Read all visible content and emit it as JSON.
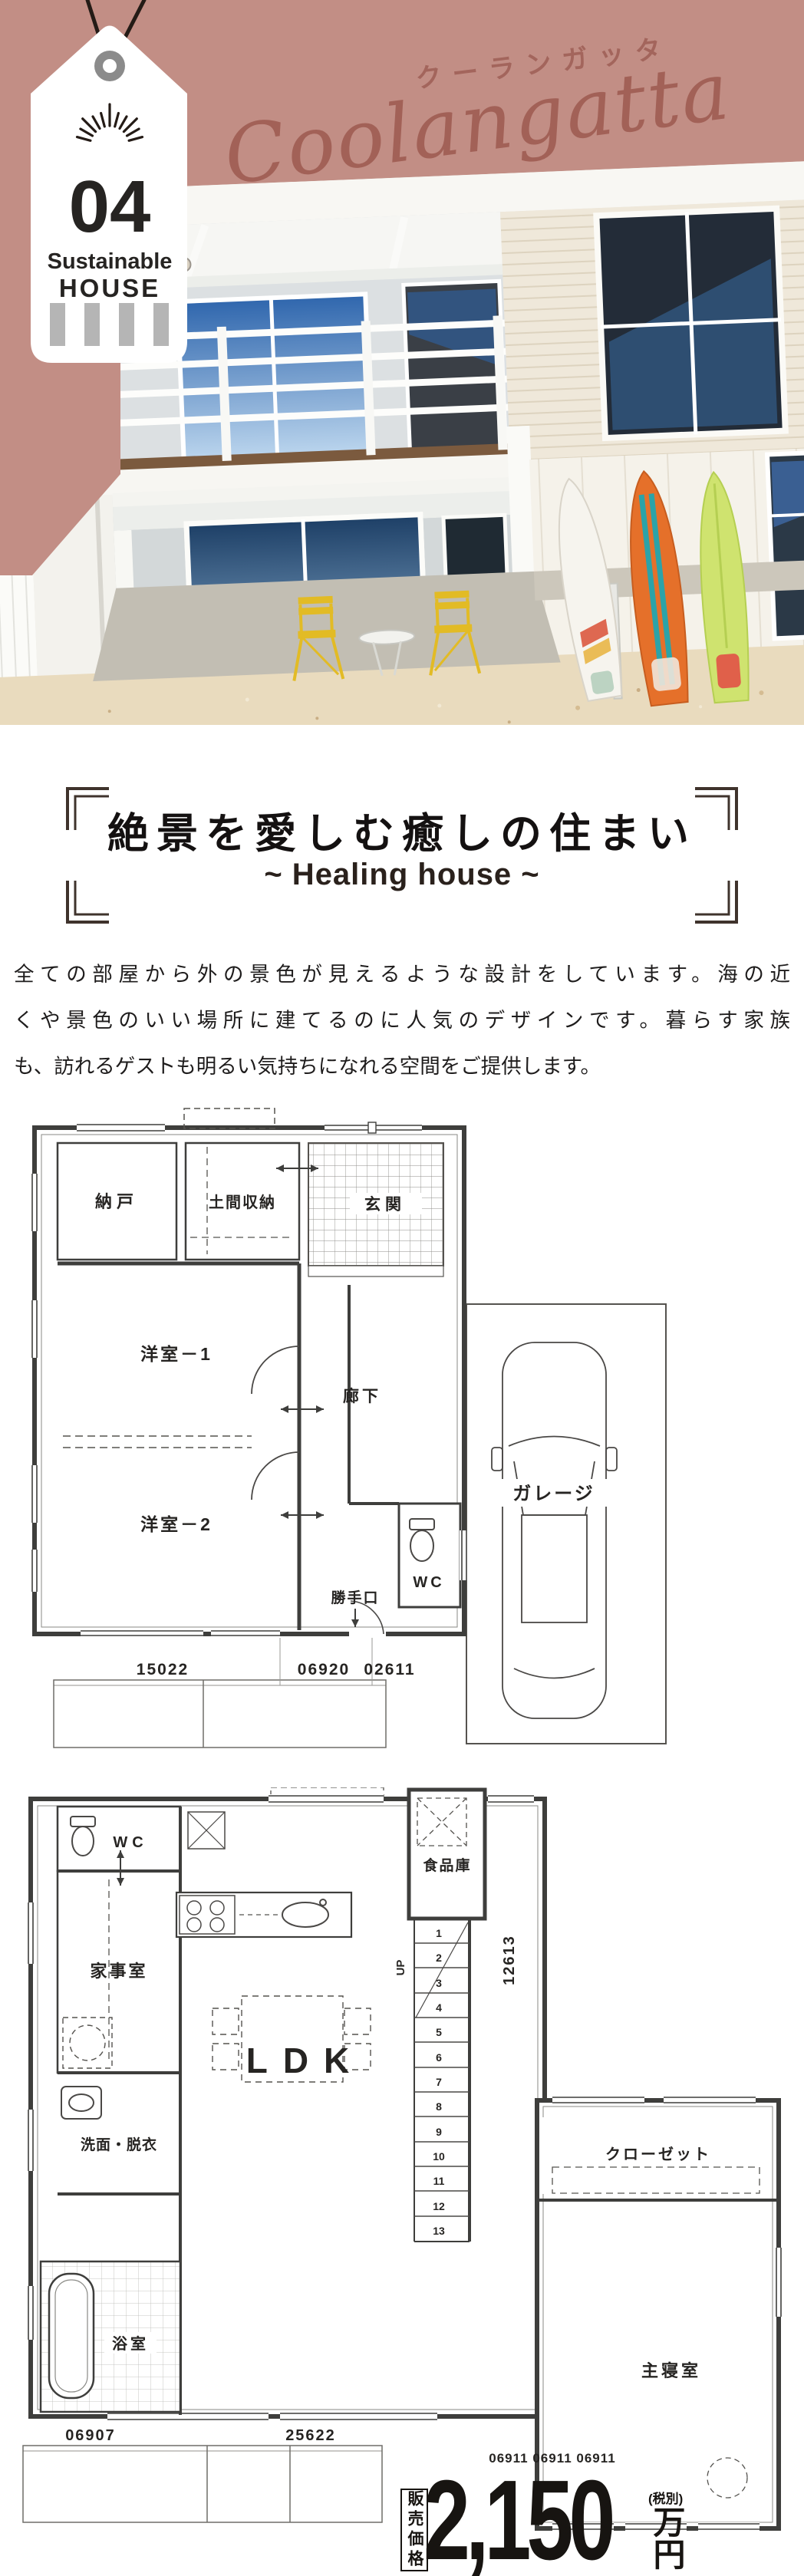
{
  "colors": {
    "rose": "#c28e85",
    "rose_dark": "#9d6057",
    "ink": "#171411"
  },
  "hero": {
    "tag": {
      "number": "04",
      "label_line1": "Sustainable",
      "label_line2": "HOUSE"
    },
    "katakana_title": "クーランガッタ",
    "script_title": "Coolangatta"
  },
  "heading": {
    "title": "絶景を愛しむ癒しの住まい",
    "subtitle": "~ Healing house ~"
  },
  "description": {
    "line1": "全ての部屋から外の景色が見えるような設計をしています。海の近",
    "line2": "くや景色のいい場所に建てるのに人気のデザインです。暮らす家族",
    "line3": "も、訪れるゲストも明るい気持ちになれる空間をご提供します。"
  },
  "floorplan1": {
    "rooms": {
      "nando": "納戸",
      "doma": "土間収納",
      "genkan": "玄関",
      "yoshitsu1": "洋室－1",
      "rouka": "廊下",
      "yoshitsu2": "洋室－2",
      "wc": "WC",
      "katteguchi": "勝手口",
      "garage": "ガレージ"
    },
    "dims": {
      "d1": "15022",
      "d2": "06920",
      "d3": "02611"
    }
  },
  "floorplan2": {
    "rooms": {
      "wc": "WC",
      "pantry": "食品庫",
      "kajishitsu": "家事室",
      "ldk": "LDK",
      "senmen": "洗面・脱衣",
      "closet": "クローゼット",
      "bath": "浴室",
      "shinshitsu": "主寝室"
    },
    "stairs": {
      "up": "UP",
      "numbers": [
        "1",
        "2",
        "3",
        "4",
        "5",
        "6",
        "7",
        "8",
        "9",
        "10",
        "11",
        "12",
        "13"
      ]
    },
    "dims": {
      "left": "06907",
      "mid": "25622",
      "side": "12613",
      "bottom_right": "06911 06911 06911"
    }
  },
  "price": {
    "label": "販売価格",
    "amount": "2,150",
    "unit": "万円",
    "tax_note": "(税別)"
  }
}
